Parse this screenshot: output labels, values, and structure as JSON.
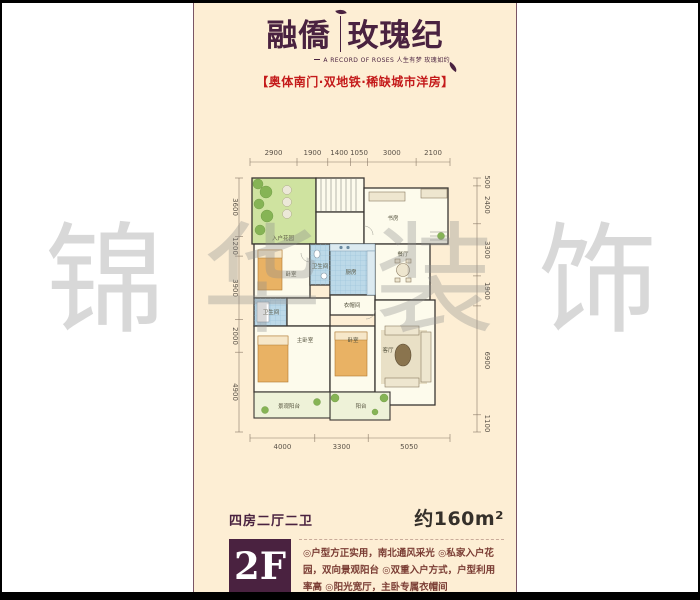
{
  "header": {
    "brand_left": "融僑",
    "brand_right": "玫瑰纪",
    "tagline": "A RECORD OF ROSES 人生有梦 玫瑰如约",
    "subtitle": "【奥体南门·双地铁·稀缺城市洋房】"
  },
  "watermark": {
    "chars": [
      "锦",
      "华",
      "装",
      "饰"
    ]
  },
  "plan": {
    "dims_top": [
      "2900",
      "1900",
      "1400",
      "1050",
      "3000",
      "2100"
    ],
    "dims_bottom": [
      "4000",
      "3300",
      "5050"
    ],
    "dims_left": [
      "3600",
      "1200",
      "3900",
      "2000",
      "4900"
    ],
    "dims_right": [
      "500",
      "2400",
      "3300",
      "1900",
      "6900",
      "1100"
    ],
    "rooms": {
      "entry_garden": "入户花园",
      "study": "书房",
      "bedroom_left": "卧室",
      "bath_center": "卫生间",
      "kitchen": "厨房",
      "dining": "餐厅",
      "cloakroom": "衣帽间",
      "bath_lower": "卫生间",
      "master_bedroom": "主卧室",
      "bedroom_bottom": "卧室",
      "living": "客厅",
      "balcony": "阳台",
      "view_balcony": "景观阳台"
    }
  },
  "footer": {
    "layout_type": "四房二厅二卫",
    "area": "约160m²",
    "floor": "2F",
    "features": "◎户型方正实用，南北通风采光 ◎私家入户花园，双向景观阳台 ◎双重入户方式，户型利用率高 ◎阳光宽厅，主卧专属衣帽间"
  },
  "colors": {
    "accent": "#4a2240",
    "red": "#c41a1a",
    "cream": "#fdeed4"
  }
}
